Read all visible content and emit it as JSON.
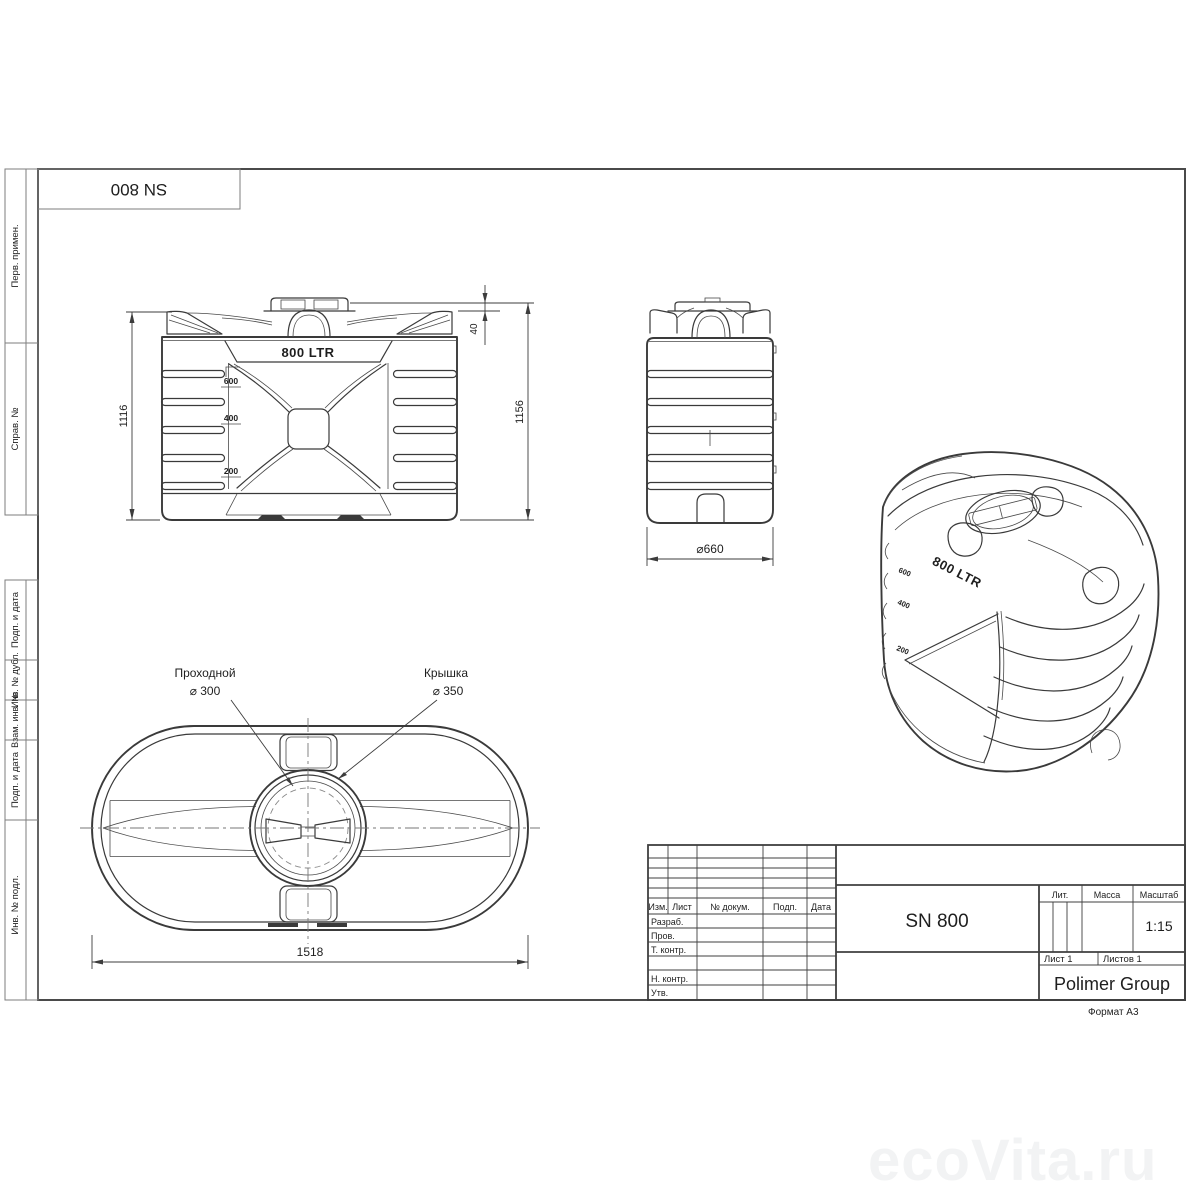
{
  "sheet": {
    "designation_flipped": "SN 800",
    "format_note": "Формат А3",
    "watermark": "ecoVita.ru"
  },
  "margin_column": {
    "perv_primen": "Перв. примен.",
    "sprav_no": "Справ. №",
    "podp_data_1": "Подп. и дата",
    "inv_no_dubl": "Инв. № дубл.",
    "vzam_inv_no": "Взам. инв. №",
    "podp_data_2": "Подп. и дата",
    "inv_no_podl": "Инв. № подл."
  },
  "front_view": {
    "capacity": "800 LTR",
    "level_marks": [
      "600",
      "400",
      "200"
    ],
    "dim_height_body": "1116",
    "dim_height_total": "1156",
    "dim_cap_height": "40"
  },
  "side_view": {
    "dim_diameter": "⌀660"
  },
  "iso_view": {
    "capacity": "800 LTR",
    "level_marks": [
      "600",
      "400",
      "200"
    ]
  },
  "top_view": {
    "callout_inlet_name": "Проходной",
    "callout_inlet_dia": "⌀ 300",
    "callout_lid_name": "Крышка",
    "callout_lid_dia": "⌀ 350",
    "dim_length": "1518"
  },
  "title_block": {
    "rev_cols": [
      "Изм.",
      "Лист",
      "№ докум.",
      "Подп.",
      "Дата"
    ],
    "roles": [
      "Разраб.",
      "Пров.",
      "Т. контр.",
      "Н. контр.",
      "Утв."
    ],
    "lit_label": "Лит.",
    "mass_label": "Масса",
    "scale_label": "Масштаб",
    "scale_value": "1:15",
    "part_name": "SN 800",
    "sheet_info": "Лист 1",
    "sheets_info": "Листов 1",
    "company": "Polimer Group"
  }
}
